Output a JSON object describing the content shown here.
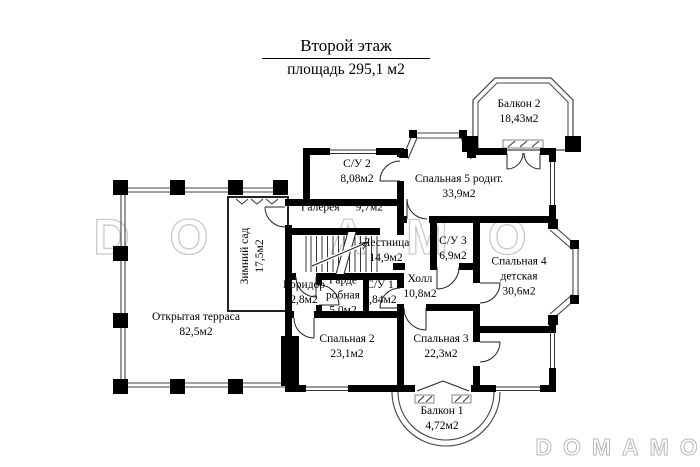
{
  "title": {
    "floor": "Второй этаж",
    "area": "площадь 295,1 м2"
  },
  "watermarks": {
    "center": "DOMAMO",
    "corner": "DOMAMO"
  },
  "rooms": {
    "balcony2": {
      "name": "Балкон 2",
      "area": "18,43м2"
    },
    "wc2": {
      "name": "С/У 2",
      "area": "8,08м2"
    },
    "bedroom5": {
      "name": "Спальная 5 родит.",
      "area": "33,9м2"
    },
    "gallery": {
      "name": "Галерея",
      "area": "9,7м2"
    },
    "winter_garden": {
      "name": "Зимний сад",
      "area": "17,5м2"
    },
    "stairs": {
      "name": "Лестница",
      "area": "14,9м2"
    },
    "wc3": {
      "name": "С/У 3",
      "area": "6,9м2"
    },
    "bedroom4": {
      "name": "Спальная 4",
      "name2": "детская",
      "area": "30,6м2"
    },
    "hall": {
      "name": "Холл",
      "area": "10,8м2"
    },
    "corridor": {
      "name": "Коридор",
      "area": "2,8м2"
    },
    "wardrobe": {
      "name": "Гарде",
      "name2": "робная",
      "area": "5,0м2"
    },
    "wc1": {
      "name": "С/У 1",
      "area": "3,84м2"
    },
    "terrace": {
      "name": "Открытая терраса",
      "area": "82,5м2"
    },
    "bedroom2": {
      "name": "Спальная 2",
      "area": "23,1м2"
    },
    "bedroom3": {
      "name": "Спальная 3",
      "area": "22,3м2"
    },
    "balcony1": {
      "name": "Балкон 1",
      "area": "4,72м2"
    }
  }
}
